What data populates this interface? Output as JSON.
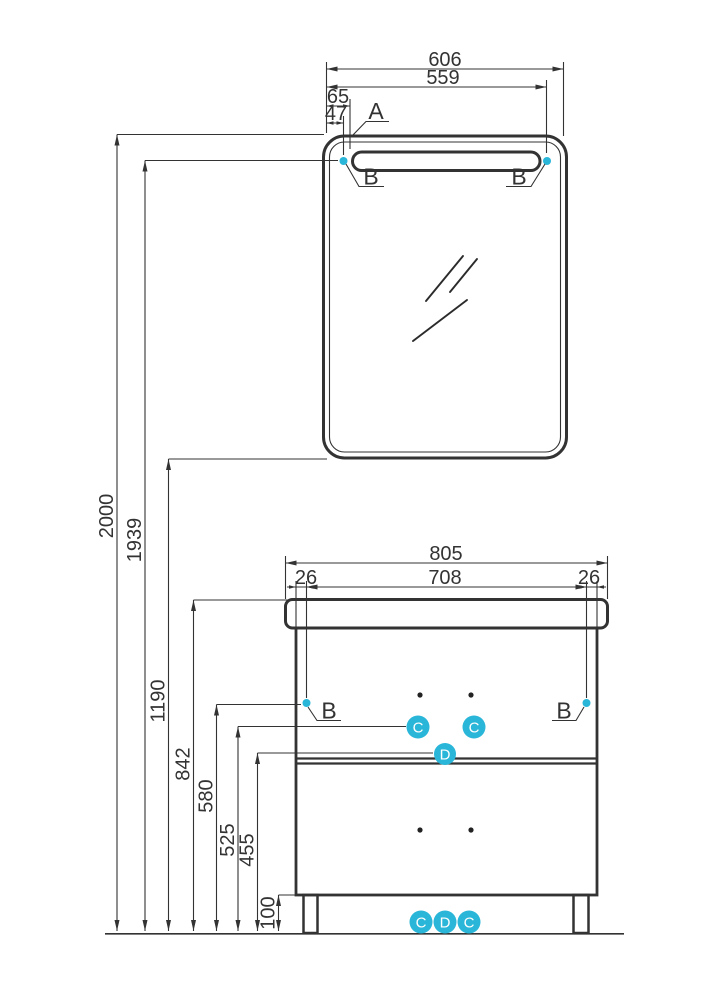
{
  "drawing_title": "bathroom-mirror-and-vanity-dimension-drawing",
  "colors": {
    "line": "#333333",
    "accent": "#29b6d8",
    "background": "#ffffff",
    "marker_letter": "#ffffff"
  },
  "mirror": {
    "dims": {
      "overall_width": "606",
      "edge_to_right_fixing": "559",
      "edge_to_slot": "65",
      "edge_to_fixing": "47"
    },
    "callout_corner": "A",
    "callout_fixing_left": "B",
    "callout_fixing_right": "B"
  },
  "heights": {
    "mirror_top": "2000",
    "light_fixings": "1939",
    "mirror_bottom": "1190",
    "countertop": "842",
    "cabinet_fixings": "580",
    "handles": "525",
    "divider": "455",
    "plinth": "100"
  },
  "cabinet": {
    "dims": {
      "overall_width": "805",
      "between_fixings": "708",
      "left_offset": "26",
      "right_offset": "26"
    },
    "callout_fixing_left": "B",
    "callout_fixing_right": "B",
    "markers": {
      "handle_left": "C",
      "handle_right": "C",
      "divider": "D"
    },
    "bottom_markers": [
      "C",
      "D",
      "C"
    ]
  }
}
